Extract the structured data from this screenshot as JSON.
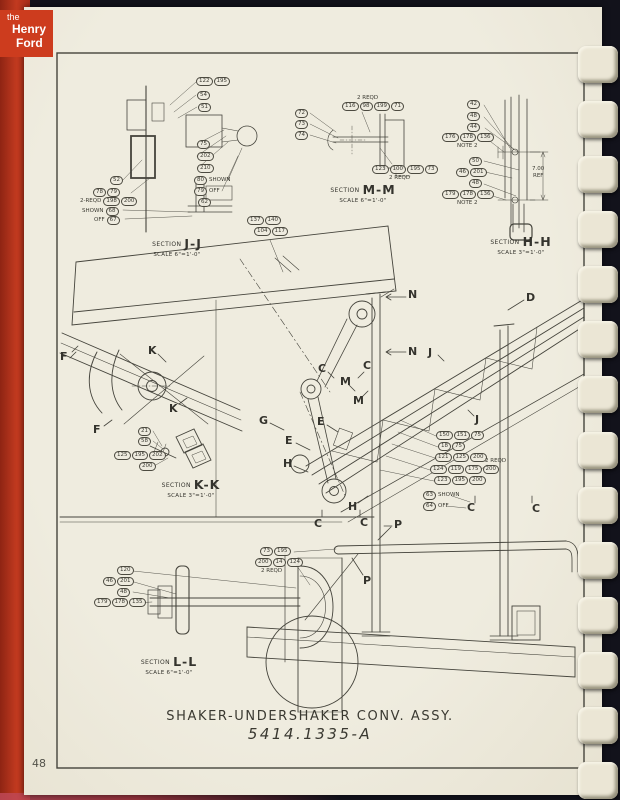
{
  "cover": {
    "logo": [
      "the",
      "Henry",
      "Ford"
    ]
  },
  "page_number": "48",
  "title_block": {
    "name": "SHAKER-UNDERSHAKER CONV. ASSY.",
    "number": "5414.1335-A"
  },
  "colors": {
    "cover_red": "#c23a20",
    "page_cream": "#ece8da",
    "ink": "#3b3a32",
    "background": "#12121b",
    "binding_tooth": "#ebe6d5"
  },
  "sections": {
    "jj": {
      "label": "SECTION",
      "name": "J-J",
      "scale": "SCALE 6\"=1'-0\""
    },
    "mm": {
      "label": "SECTION",
      "name": "M-M",
      "scale": "SCALE 6\"=1'-0\""
    },
    "hh": {
      "label": "SECTION",
      "name": "H-H",
      "scale": "SCALE 3\"=1'-0\""
    },
    "kk": {
      "label": "SECTION",
      "name": "K-K",
      "scale": "SCALE 3\"=1'-0\""
    },
    "ll": {
      "label": "SECTION",
      "name": "L-L",
      "scale": "SCALE 6\"=1'-0\""
    }
  },
  "view_letters": {
    "f": "F",
    "k": "K",
    "c": "C",
    "m": "M",
    "n": "N",
    "j": "J",
    "g": "G",
    "e": "E",
    "h": "H",
    "p": "P",
    "d": "D"
  },
  "annotations": {
    "shown": "SHOWN",
    "off": "OFF",
    "reqd2": "2 REQD",
    "reqd2_dash": "2-REQD",
    "note2": "NOTE 2",
    "dim": "7.00",
    "ref": "REF"
  },
  "callouts": {
    "jj": {
      "r1": [
        "122",
        "195"
      ],
      "r2": [
        "54"
      ],
      "r3": [
        "51"
      ],
      "r4": [
        "75"
      ],
      "r5": [
        "202"
      ],
      "r6": [
        "210"
      ],
      "r7": [
        "80"
      ],
      "r8": [
        "79"
      ],
      "r9": [
        "62"
      ],
      "l1": [
        "52"
      ],
      "l2": [
        "78",
        "79"
      ],
      "l3": [
        "198",
        "200"
      ],
      "l4": [
        "68"
      ],
      "l5": [
        "67"
      ]
    },
    "panel": {
      "r1": [
        "137",
        "140"
      ],
      "r2": [
        "104",
        "117"
      ]
    },
    "mm": {
      "l1": [
        "72"
      ],
      "l2": [
        "73"
      ],
      "l3": [
        "74"
      ],
      "top": [
        "116",
        "98",
        "199",
        "71"
      ],
      "bottom": [
        "123",
        "100",
        "195",
        "73"
      ]
    },
    "hh": {
      "r1": [
        "42"
      ],
      "r2": [
        "48"
      ],
      "r3": [
        "44"
      ],
      "r4": [
        "176",
        "178",
        "136"
      ],
      "r5": [
        "50"
      ],
      "r6": [
        "46",
        "201"
      ],
      "r7": [
        "48"
      ],
      "r8": [
        "179",
        "178",
        "136"
      ]
    },
    "kk": {
      "r1": [
        "21"
      ],
      "r2": [
        "58"
      ],
      "r3": [
        "125",
        "195",
        "202"
      ],
      "r4": [
        "200"
      ]
    },
    "ll": {
      "r1": [
        "120"
      ],
      "r2": [
        "46",
        "201"
      ],
      "r3": [
        "48"
      ],
      "r4": [
        "179",
        "178",
        "135"
      ]
    },
    "center": {
      "r1": [
        "150",
        "151",
        "75"
      ],
      "r2": [
        "18",
        "75"
      ],
      "r3": [
        "121",
        "125",
        "200"
      ],
      "r4": [
        "124",
        "119",
        "175",
        "200"
      ],
      "r5": [
        "123",
        "195",
        "200"
      ],
      "r6": [
        "63"
      ],
      "r7": [
        "64"
      ]
    },
    "pipe": {
      "r1": [
        "73",
        "195"
      ],
      "r2": [
        "200",
        "14",
        "124"
      ]
    }
  }
}
